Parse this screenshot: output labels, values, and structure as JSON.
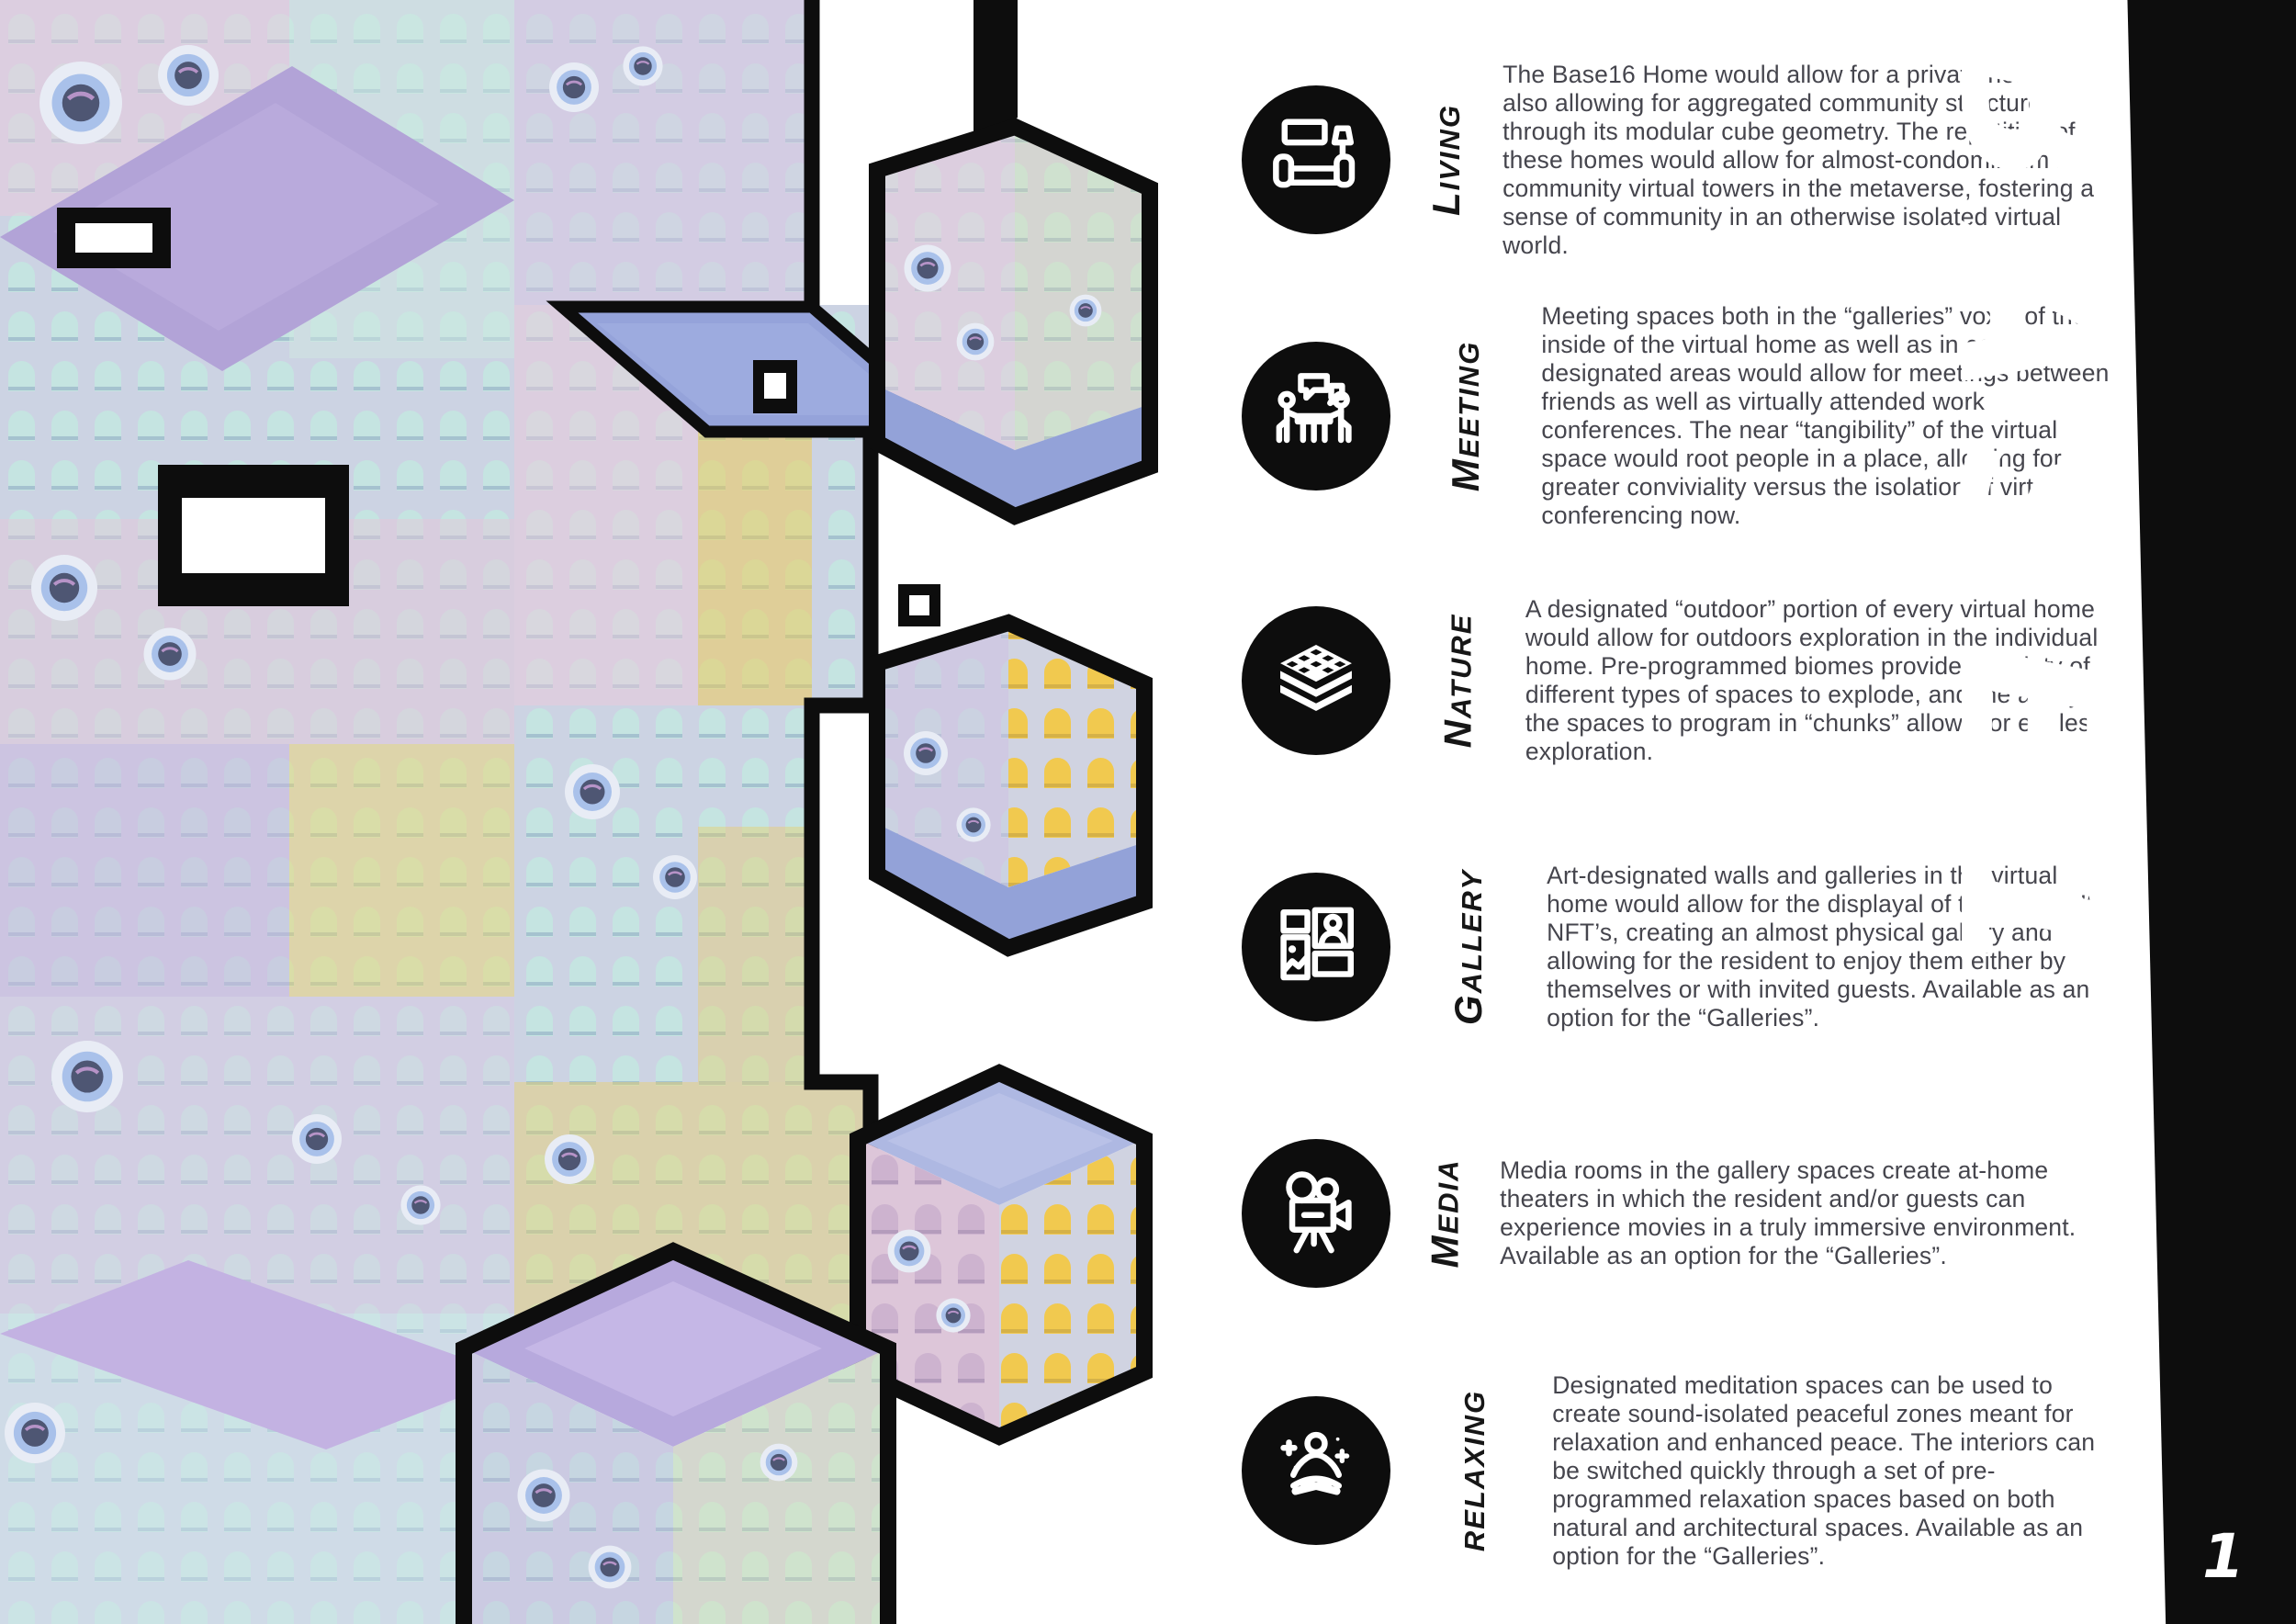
{
  "theme": {
    "colors": {
      "ink": "#0d0d0d",
      "paper": "#ffffff",
      "body_text": "#45454d",
      "label_text": "#161616",
      "brand_text": "#ffffff"
    }
  },
  "sidebar": {
    "brand": "BASE16",
    "page_number": "1"
  },
  "artwork": {
    "alt": "Isometric render of stacked modular pastel cubes with arched windows and round portholes, outlined in thick black",
    "palette": {
      "face_base": "#ccd3e3",
      "slab_lavender": "#b2a3d7",
      "slab_blue": "#95a3da",
      "tint_pink": "#eccade",
      "tint_lilac": "#cbb6e0",
      "tint_teal": "#cfe7e2",
      "window_yellow": "#f2ca4e",
      "porthole_ring": "#a9c1ea"
    }
  },
  "sections": [
    {
      "label_initial": "L",
      "label_rest": "IVING",
      "icon": "living-room-icon",
      "text": "The Base16 Home would allow for a private home while also allowing for aggregated community structures through its modular cube geometry. The repetition of these homes would allow for almost-condominium like community virtual towers in the metaverse, fostering a sense of community in an otherwise isolated virtual world."
    },
    {
      "label_initial": "M",
      "label_rest": "EETING",
      "icon": "meeting-icon",
      "text": "Meeting spaces both in the “galleries” voxel of the inside of the virtual home as well as in community designated areas would allow for meetings between friends as well as virtually attended work conferences. The near “tangibility” of the virtual space would root people in a place, allowing for greater conviviality versus the isolation of virtual conferencing now."
    },
    {
      "label_initial": "N",
      "label_rest": "ATURE",
      "icon": "nature-layers-icon",
      "text": "A designated “outdoor” portion of every virtual home would allow for outdoors exploration in the individual home. Pre-programmed biomes provide a variety of different types of spaces to explode, and the ability for the spaces to program in “chunks” allows for endless exploration."
    },
    {
      "label_initial": "G",
      "label_rest": "ALLERY",
      "icon": "gallery-frames-icon",
      "text": "Art-designated walls and galleries in the virtual home would allow for the displayal of the residen’ts NFT’s, creating an almost physical gallery and allowing for the resident to enjoy them either by themselves or with invited guests. Available as an option for the “Galleries”."
    },
    {
      "label_initial": "M",
      "label_rest": "EDIA",
      "icon": "media-camera-icon",
      "text": "Media rooms in the gallery spaces create at-home theaters in which the resident and/or guests can experience movies in a truly immersive environment. Available as an option for the “Galleries”."
    },
    {
      "label_initial": "",
      "label_rest": "RELAXING",
      "icon": "relaxing-meditation-icon",
      "text": "Designated meditation spaces can be used to create sound-isolated peaceful zones meant for relaxation and enhanced peace. The interiors can be switched quickly through a set of pre-programmed relaxation spaces based on both natural and architectural spaces. Available as an option for the “Galleries”."
    }
  ]
}
